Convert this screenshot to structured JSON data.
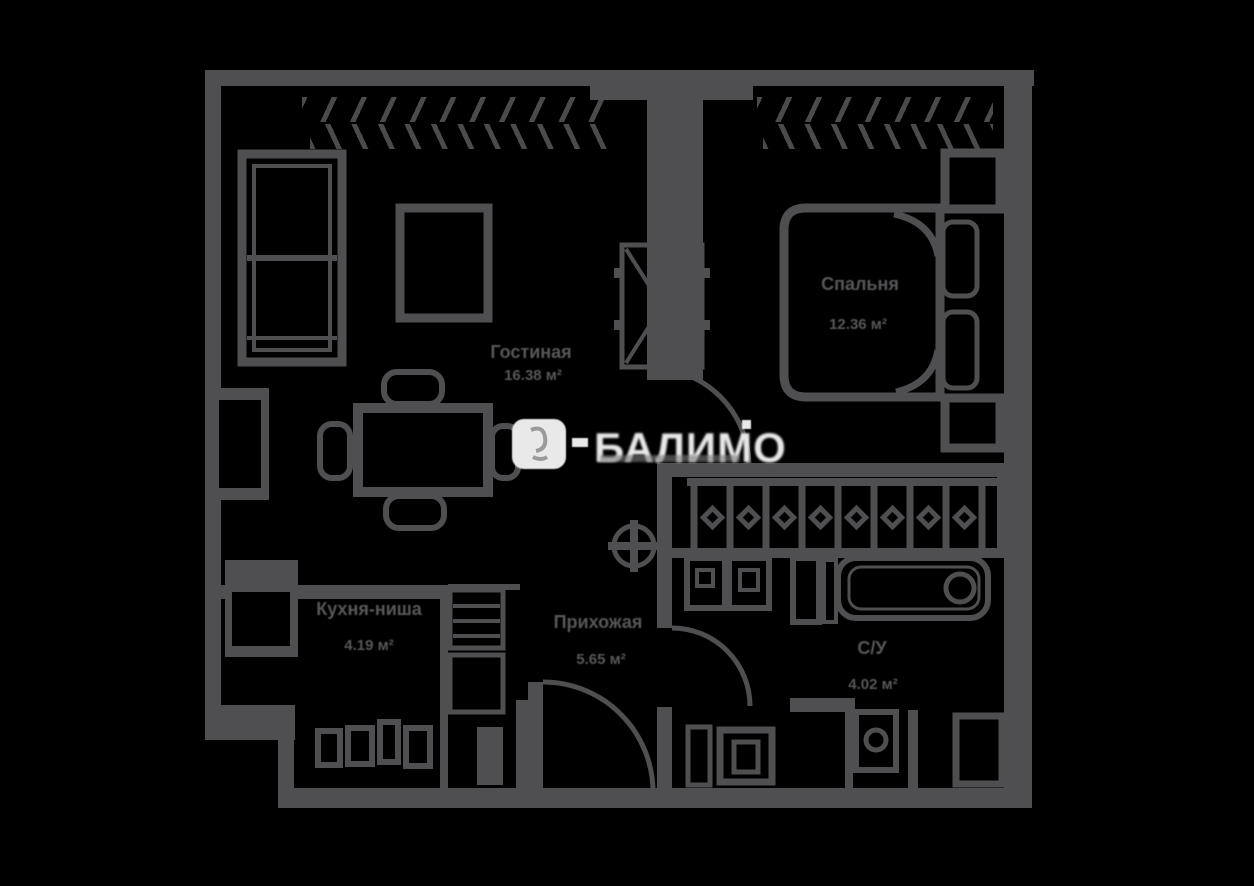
{
  "title": "floor-plan",
  "colors": {
    "background": "#000000",
    "wall": "#4f4f51",
    "label": "#57575a",
    "watermark": "#e9e9e9"
  },
  "watermark": {
    "text": "БАЛИМО"
  },
  "rooms": {
    "living": {
      "name": "Гостиная",
      "area": "16.38 м²"
    },
    "bedroom": {
      "name": "Спальня",
      "area": "12.36 м²"
    },
    "kitchen": {
      "name": "Кухня-ниша",
      "area": "4.19 м²"
    },
    "hallway": {
      "name": "Прихожая",
      "area": "5.65 м²"
    },
    "bathroom": {
      "name": "С/У",
      "area": "4.02 м²"
    }
  }
}
